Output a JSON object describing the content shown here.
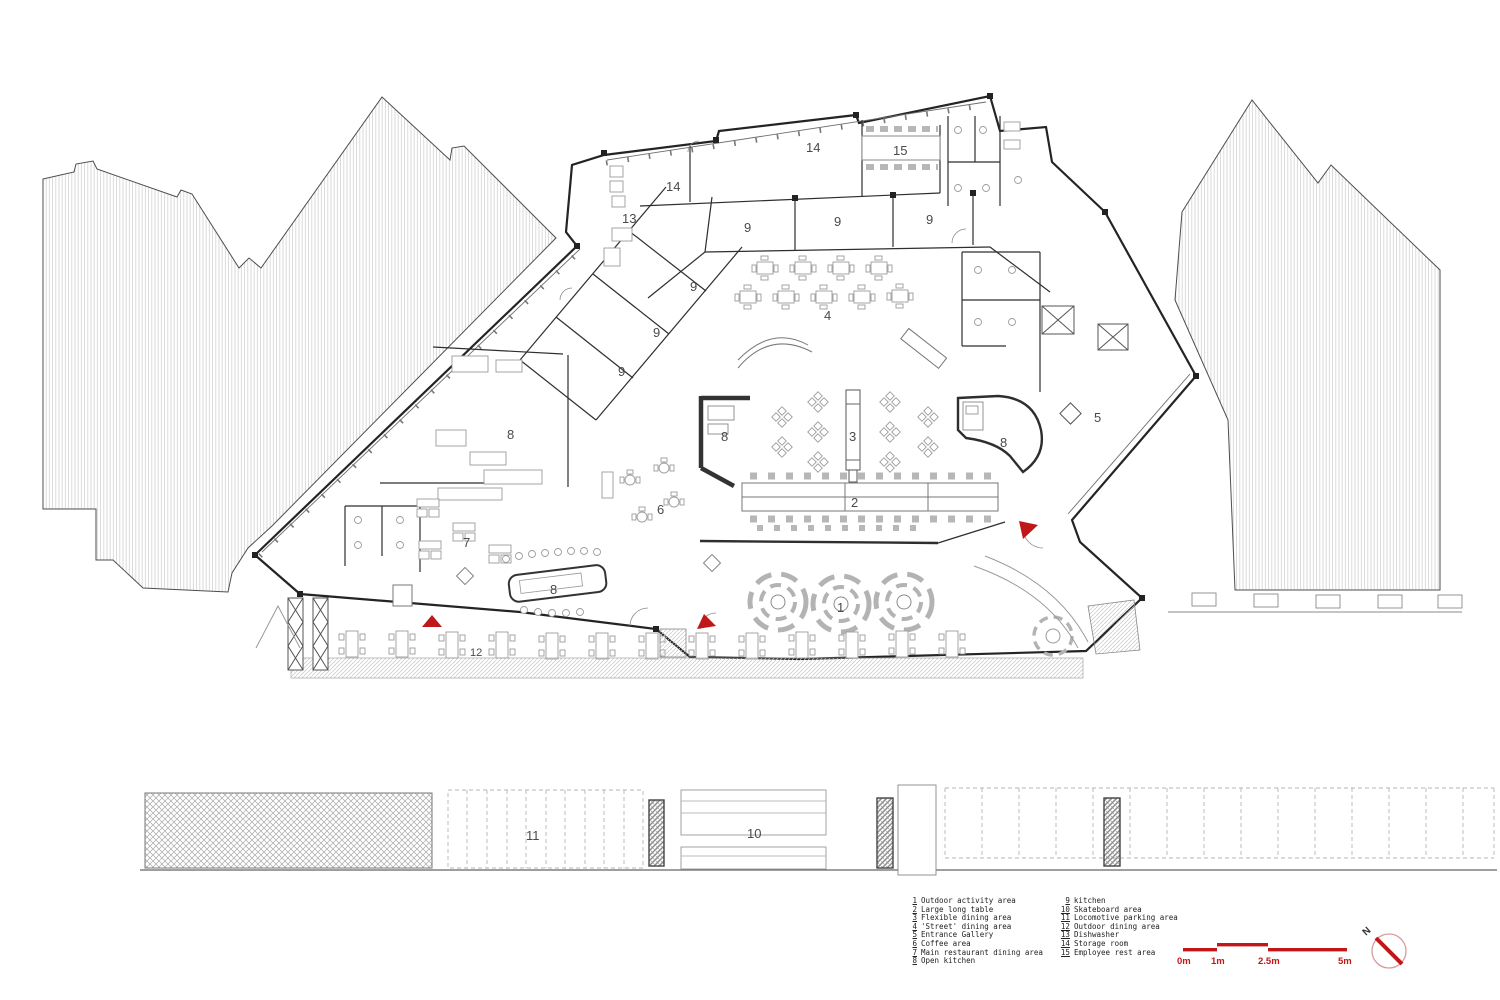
{
  "plan": {
    "labels": [
      {
        "t": "14"
      },
      {
        "t": "15"
      },
      {
        "t": "14"
      },
      {
        "t": "13"
      },
      {
        "t": "9"
      },
      {
        "t": "9"
      },
      {
        "t": "9"
      },
      {
        "t": "9"
      },
      {
        "t": "9"
      },
      {
        "t": "9"
      },
      {
        "t": "8"
      },
      {
        "t": "7"
      },
      {
        "t": "8"
      },
      {
        "t": "8"
      },
      {
        "t": "6"
      },
      {
        "t": "3"
      },
      {
        "t": "2"
      },
      {
        "t": "1"
      },
      {
        "t": "8"
      },
      {
        "t": "5"
      },
      {
        "t": "4"
      },
      {
        "t": "12"
      },
      {
        "t": "11"
      },
      {
        "t": "10"
      }
    ]
  },
  "legend": {
    "items": [
      {
        "num": "1",
        "label": "Outdoor activity area"
      },
      {
        "num": "2",
        "label": "Large long table"
      },
      {
        "num": "3",
        "label": "Flexible dining area"
      },
      {
        "num": "4",
        "label": "'Street' dining area"
      },
      {
        "num": "5",
        "label": "Entrance Gallery"
      },
      {
        "num": "6",
        "label": "Coffee area"
      },
      {
        "num": "7",
        "label": "Main restaurant dining area"
      },
      {
        "num": "8",
        "label": "Open kitchen"
      },
      {
        "num": "9",
        "label": "kitchen"
      },
      {
        "num": "10",
        "label": "Skateboard area"
      },
      {
        "num": "11",
        "label": "Locomotive parking area"
      },
      {
        "num": "12",
        "label": "Outdoor dining area"
      },
      {
        "num": "13",
        "label": "Dishwasher"
      },
      {
        "num": "14",
        "label": "Storage room"
      },
      {
        "num": "15",
        "label": "Employee rest area"
      }
    ]
  },
  "scalebar": {
    "labels": [
      "0m",
      "1m",
      "2.5m",
      "5m"
    ]
  },
  "compass": {
    "north_label": "N"
  },
  "colors": {
    "accent_red": "#c01818",
    "wall": "#2b2b2b",
    "furniture": "#9b9b9b"
  }
}
